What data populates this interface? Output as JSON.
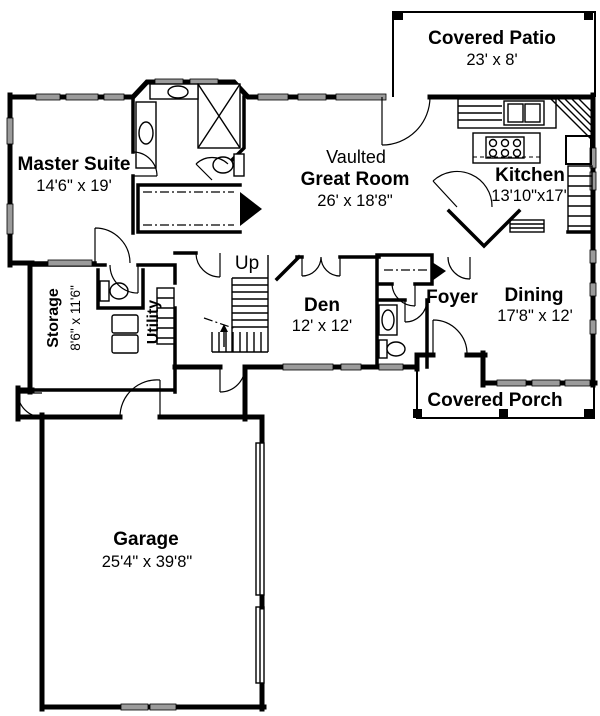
{
  "plan": {
    "type": "floor-plan",
    "colors": {
      "background": "#ffffff",
      "walls": "#000000",
      "windows": "#9b9b9b",
      "text": "#000000"
    },
    "rooms": [
      {
        "id": "covered-patio",
        "name": "Covered Patio",
        "dims": "23' x 8'"
      },
      {
        "id": "master-suite",
        "name": "Master Suite",
        "dims": "14'6\" x 19'"
      },
      {
        "id": "great-room",
        "prefix": "Vaulted",
        "name": "Great Room",
        "dims": "26' x 18'8\""
      },
      {
        "id": "kitchen",
        "name": "Kitchen",
        "dims": "13'10\"x17'"
      },
      {
        "id": "storage",
        "name": "Storage",
        "dims": "8'6\" x 11'6\""
      },
      {
        "id": "utility",
        "name": "Utility"
      },
      {
        "id": "stairs",
        "name": "Up"
      },
      {
        "id": "den",
        "name": "Den",
        "dims": "12' x 12'"
      },
      {
        "id": "foyer",
        "name": "Foyer"
      },
      {
        "id": "dining",
        "name": "Dining",
        "dims": "17'8\" x 12'"
      },
      {
        "id": "covered-porch",
        "name": "Covered Porch"
      },
      {
        "id": "garage",
        "name": "Garage",
        "dims": "25'4\" x 39'8\""
      }
    ]
  }
}
